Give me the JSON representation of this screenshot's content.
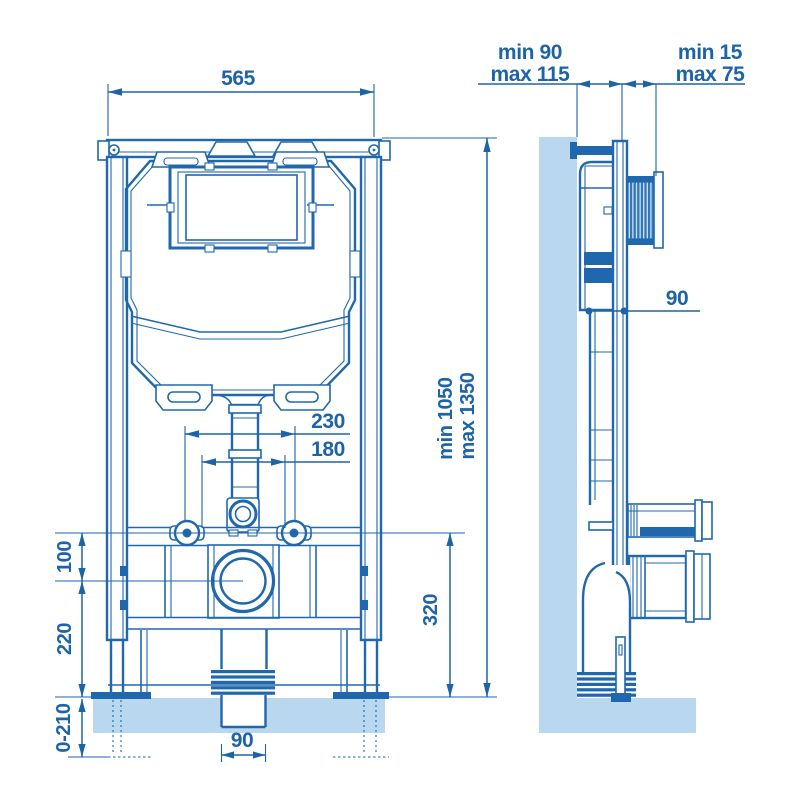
{
  "title": "Concealed WC frame installation drawing",
  "colors": {
    "line": "#2068ad",
    "text": "#1d63a8",
    "wall_fill": "#b9d7ee",
    "stripe_fill": "#3277b8",
    "background": "#ffffff"
  },
  "front_view": {
    "labels": {
      "frame_width": "565",
      "bolt_spacing": "230",
      "inner_spacing": "180",
      "height_min": "min 1050",
      "height_max": "max 1350",
      "bolt_to_outlet": "100",
      "outlet_height": "220",
      "feet_range": "0-210",
      "fixing_height": "320",
      "waste_pipe_width": "90"
    }
  },
  "side_view": {
    "labels": {
      "depth_min": "min 90",
      "depth_max": "max 115",
      "plate_min": "min 15",
      "plate_max": "max 75",
      "cistern_depth": "90"
    }
  }
}
